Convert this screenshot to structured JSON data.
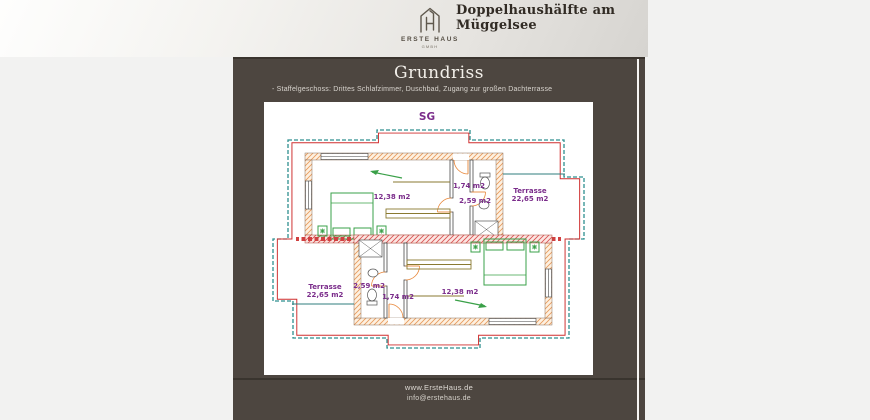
{
  "header": {
    "title": "Doppelhaushälfte am Müggelsee",
    "brand": {
      "name": "ERSTE HAUS",
      "legal": "GMBH"
    }
  },
  "slide": {
    "heading": "Grundriss",
    "subtitle": "- Staffelgeschoss: Drittes Schlafzimmer, Duschbad, Zugang zur großen Dachterrasse",
    "footer": {
      "website": "www.ErsteHaus.de",
      "email": "info@erstehaus.de"
    }
  },
  "floorplan": {
    "level_label": "SG",
    "unit_top": {
      "bedroom_area": "12,38 m2",
      "hall_area": "1,74 m2",
      "bath_area": "2,59 m2",
      "terrace_label": "Terrasse",
      "terrace_area": "22,65 m2"
    },
    "unit_bottom": {
      "bedroom_area": "12,38 m2",
      "hall_area": "1,74 m2",
      "bath_area": "2,59 m2",
      "terrace_label": "Terrasse",
      "terrace_area": "22,65 m2"
    },
    "colors": {
      "outline": "#2e8f8f",
      "roof_line": "#cf2e2e",
      "wall_hatch": "#e8995a",
      "party_wall": "#d85050",
      "furniture": "#3aa048",
      "labels": "#7b2d8b"
    }
  }
}
